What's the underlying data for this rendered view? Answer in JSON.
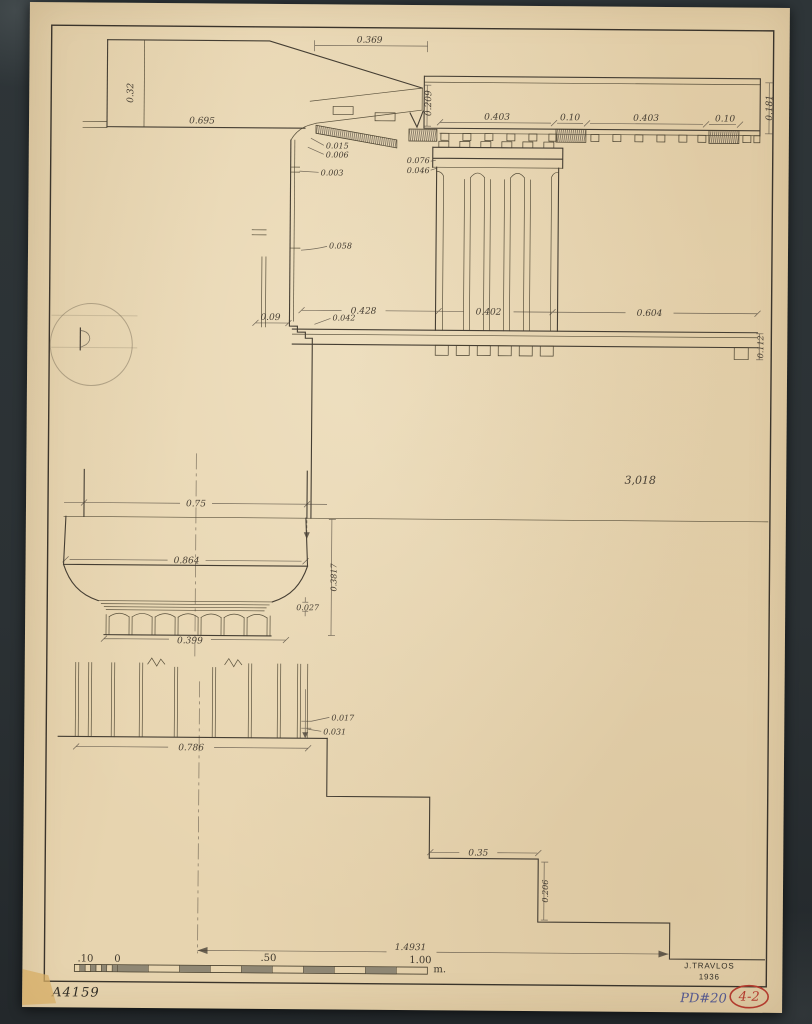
{
  "document": {
    "author_signature": "J.TRAVLOS",
    "signature_year": "1936",
    "catalog_number": "A4159",
    "plate_code": "PD#20",
    "page_ref": "4-2"
  },
  "annotations": {
    "overall_height": "3,018",
    "axis_to_step_edge": "1.4931"
  },
  "scale_bar": {
    "minor_left": ".10",
    "zero": "0",
    "mid": ".50",
    "end": "1.00",
    "unit": "m."
  },
  "dims": {
    "raking_geison_top": "0.369",
    "geison_face_height": "0.32",
    "geison_soffit": "0.695",
    "geison_drop": "0.209",
    "corona_face": "0.181",
    "mutule_a": "0.403",
    "via_a": "0.10",
    "mutule_b": "0.403",
    "via_b": "0.10",
    "bed_molding_1": "0.015",
    "bed_molding_2": "0.006",
    "bed_molding_3": "0.003",
    "taenia": "0.076",
    "regula": "0.046",
    "annulet_step": "0.058",
    "metope": "0.428",
    "triglyph": "0.402",
    "interaxial": "0.604",
    "abacus_step": "0.042",
    "abacus_back": "0.09",
    "band_height": "0.112",
    "architrave_soffit": "0.75",
    "abacus_width": "0.864",
    "capital_height": "0.3817",
    "annulet_band": "0.027",
    "neck_width": "0.399",
    "arris_a": "0.017",
    "arris_b": "0.031",
    "shaft_width": "0.786",
    "tread": "0.35",
    "riser": "0.206"
  }
}
